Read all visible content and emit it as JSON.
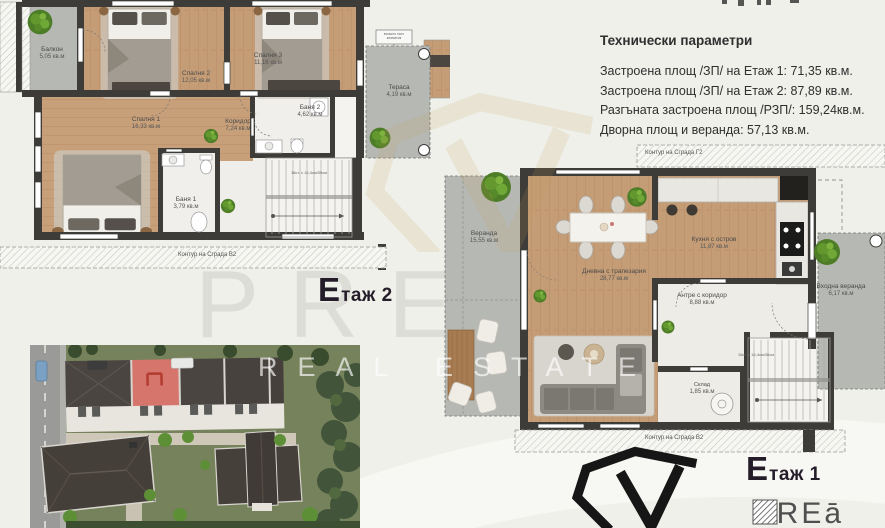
{
  "watermark": {
    "brand": "PREMIER",
    "subtitle": "REAL ESTATE"
  },
  "tech_params": {
    "title": "Технически параметри",
    "lines": [
      "Застроена площ /ЗП/ на Етаж 1: 71,35 кв.м.",
      "Застроена площ /ЗП/ на Етаж 2: 87,89 кв.м.",
      "Разгъната застроена площ /РЗП/: 159,24кв.м.",
      "Дворна площ и веранда: 57,13 кв.м."
    ]
  },
  "floor2": {
    "title_big": "Е",
    "title_small": "таж 2",
    "contour_bottom": "Контур на Сграда В2",
    "stairs_note": "16ст. х 16,4см/30см",
    "ac_unit_note": "външно тяло климатик",
    "rooms": [
      {
        "name": "Балкон",
        "area": "5,05 кв.м"
      },
      {
        "name": "Спалня 2",
        "area": "12,05 кв.м"
      },
      {
        "name": "Спалня 3",
        "area": "11,16 кв.м"
      },
      {
        "name": "Тераса",
        "area": "4,19 кв.м"
      },
      {
        "name": "Спалня 1",
        "area": "16,33 кв.м"
      },
      {
        "name": "Коридор",
        "area": "7,24 кв.м"
      },
      {
        "name": "Баня 2",
        "area": "4,62 кв.м"
      },
      {
        "name": "Баня 1",
        "area": "3,79 кв.м"
      }
    ]
  },
  "floor1": {
    "title_big": "Е",
    "title_small": "таж 1",
    "contour_top": "Контур на Сграда Г2",
    "contour_bottom": "Контур на Сграда В2",
    "stairs_note": "16ст. х 16,4см/30см",
    "rooms": [
      {
        "name": "Веранда",
        "area": "15,55 кв.м"
      },
      {
        "name": "Дневна с трапезария",
        "area": "28,77 кв.м"
      },
      {
        "name": "Кухня с остров",
        "area": "11,87 кв.м"
      },
      {
        "name": "Антре с коридор",
        "area": "8,88 кв.м"
      },
      {
        "name": "Входна веранда",
        "area": "6,17 кв.м"
      },
      {
        "name": "Склад",
        "area": "1,85 кв.м"
      }
    ]
  },
  "logos": {
    "crea_text": "CREā"
  },
  "colors": {
    "wall": "#3d3c38",
    "wood": "#c49c75",
    "concrete": "#b6b8b4",
    "tile": "#efeeea",
    "title": "#241c28",
    "highlight_roof": "#d5756b",
    "watermark_gold": "#c9a05e",
    "tree_green": "#4e7d28"
  }
}
